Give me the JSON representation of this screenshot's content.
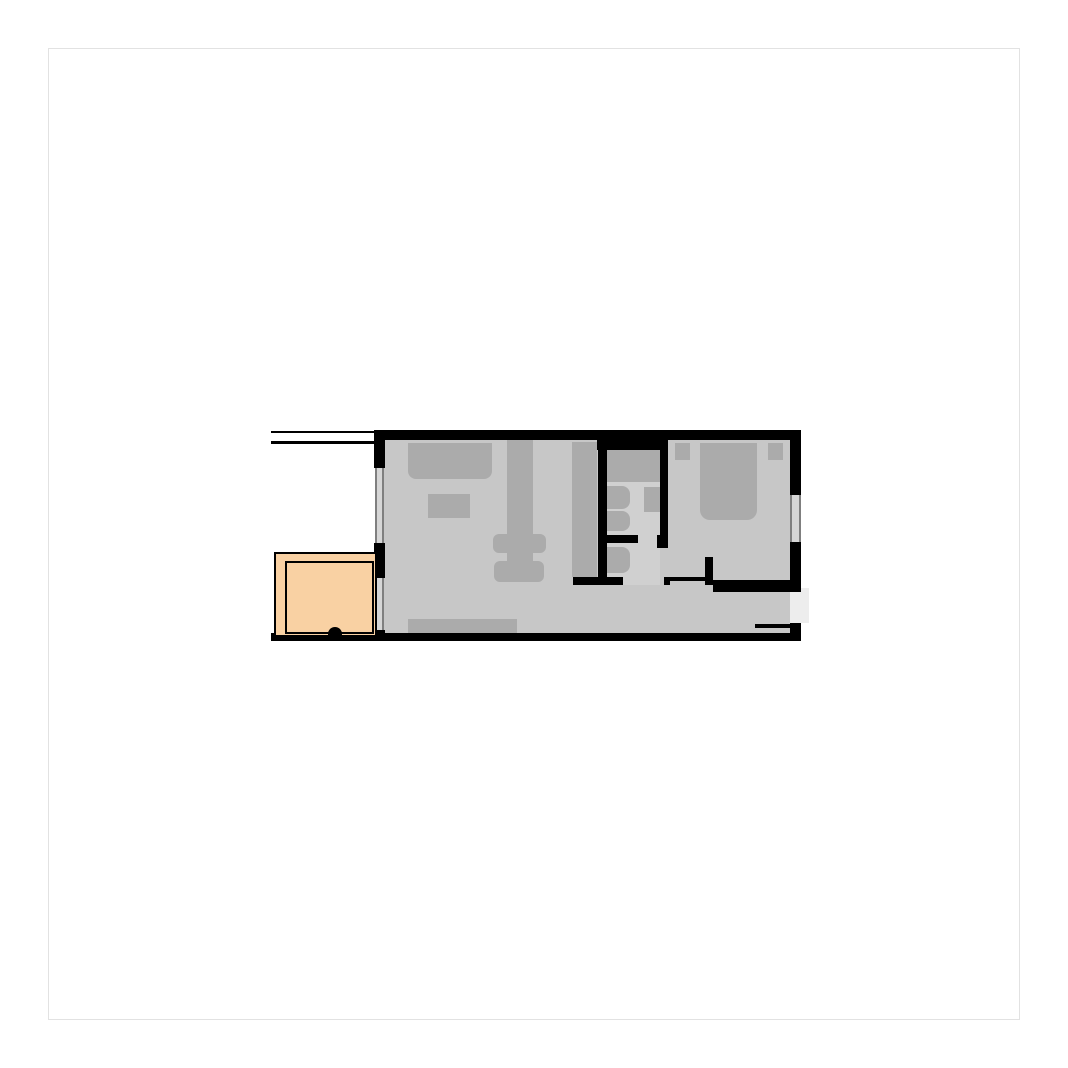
{
  "canvas": {
    "background": "#ffffff",
    "frame_color": "#e2e2e2"
  },
  "floorplan": {
    "colors": {
      "wall": "#000000",
      "floor": "#c7c7c7",
      "bath_floor": "#d0d0d0",
      "furniture": "#ababab",
      "window_glass": "#d6d6d6",
      "window_line": "#7f7f7f",
      "porch_fill": "#f9d1a3",
      "opening": "#ededed",
      "frame_color": "#e2e2e2"
    }
  }
}
